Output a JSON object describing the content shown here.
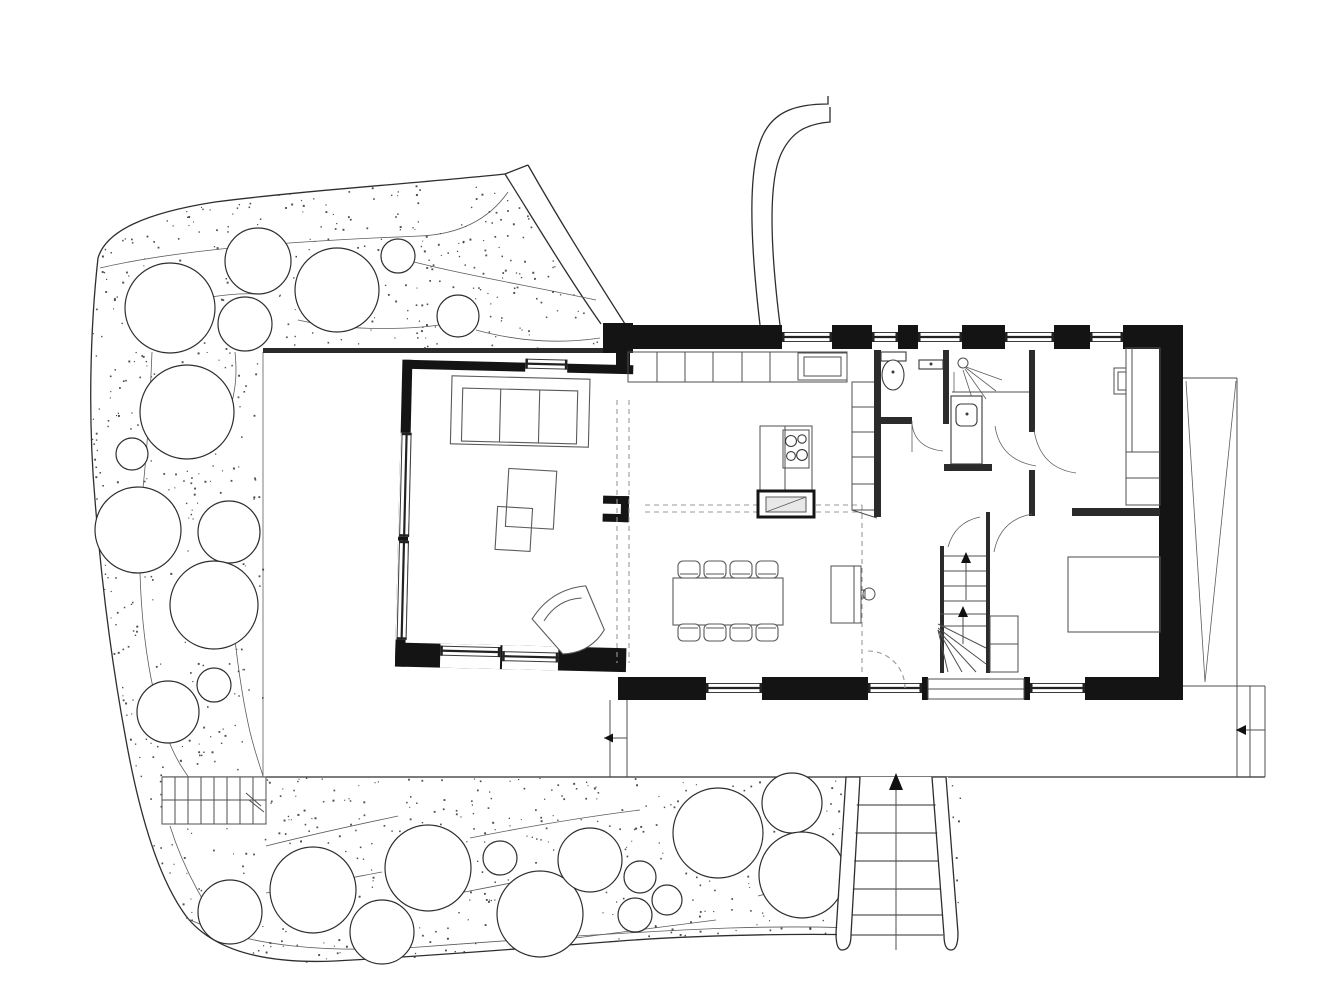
{
  "document": {
    "title": "Site and ground floor plan — black and white architectural line drawing"
  },
  "canvas": {
    "width": 1338,
    "height": 992,
    "background": "#ffffff"
  },
  "palette": {
    "wall": "#141414",
    "outline": "#2e2e2e",
    "thin_line": "#4f4f4f",
    "furniture": "#5a5a5a",
    "dashed": "#999999",
    "stipple": "#2f2f2f",
    "hearth_fill": "#e8e8e8"
  },
  "garden": {
    "stipple": {
      "count": 820,
      "seed": 13,
      "min_size": 1.0,
      "max_size": 2.0
    },
    "band_polygon": [
      [
        505,
        174
      ],
      [
        400,
        184
      ],
      [
        290,
        192
      ],
      [
        215,
        202
      ],
      [
        150,
        213
      ],
      [
        110,
        230
      ],
      [
        98,
        258
      ],
      [
        91,
        330
      ],
      [
        90,
        420
      ],
      [
        95,
        500
      ],
      [
        103,
        590
      ],
      [
        113,
        670
      ],
      [
        126,
        740
      ],
      [
        140,
        812
      ],
      [
        160,
        878
      ],
      [
        186,
        916
      ],
      [
        216,
        950
      ],
      [
        270,
        963
      ],
      [
        335,
        961
      ],
      [
        430,
        956
      ],
      [
        530,
        948
      ],
      [
        620,
        941
      ],
      [
        720,
        934
      ],
      [
        820,
        933
      ],
      [
        905,
        936
      ],
      [
        958,
        934
      ],
      [
        960,
        779
      ],
      [
        263,
        777
      ],
      [
        263,
        352
      ],
      [
        603,
        350
      ],
      [
        570,
        285
      ],
      [
        535,
        205
      ]
    ],
    "trees": [
      {
        "cx": 170,
        "cy": 308,
        "r": 45
      },
      {
        "cx": 258,
        "cy": 261,
        "r": 33
      },
      {
        "cx": 337,
        "cy": 290,
        "r": 42
      },
      {
        "cx": 398,
        "cy": 256,
        "r": 17
      },
      {
        "cx": 245,
        "cy": 324,
        "r": 27
      },
      {
        "cx": 458,
        "cy": 316,
        "r": 21
      },
      {
        "cx": 187,
        "cy": 412,
        "r": 47
      },
      {
        "cx": 132,
        "cy": 454,
        "r": 16
      },
      {
        "cx": 138,
        "cy": 530,
        "r": 43
      },
      {
        "cx": 229,
        "cy": 532,
        "r": 31
      },
      {
        "cx": 214,
        "cy": 605,
        "r": 44
      },
      {
        "cx": 214,
        "cy": 685,
        "r": 17
      },
      {
        "cx": 168,
        "cy": 712,
        "r": 31
      },
      {
        "cx": 230,
        "cy": 912,
        "r": 32
      },
      {
        "cx": 313,
        "cy": 890,
        "r": 43
      },
      {
        "cx": 382,
        "cy": 932,
        "r": 32
      },
      {
        "cx": 428,
        "cy": 868,
        "r": 43
      },
      {
        "cx": 500,
        "cy": 858,
        "r": 17
      },
      {
        "cx": 540,
        "cy": 914,
        "r": 43
      },
      {
        "cx": 590,
        "cy": 860,
        "r": 32
      },
      {
        "cx": 640,
        "cy": 877,
        "r": 16
      },
      {
        "cx": 667,
        "cy": 900,
        "r": 15
      },
      {
        "cx": 635,
        "cy": 915,
        "r": 17
      },
      {
        "cx": 718,
        "cy": 833,
        "r": 45
      },
      {
        "cx": 792,
        "cy": 803,
        "r": 30
      },
      {
        "cx": 802,
        "cy": 875,
        "r": 43
      }
    ]
  },
  "windows": [
    {
      "group": "main",
      "o": "h",
      "a": 782,
      "b": 832,
      "mid": 337,
      "punch": [
        782,
        325,
        50,
        24
      ]
    },
    {
      "group": "main",
      "o": "h",
      "a": 872,
      "b": 898,
      "mid": 337,
      "punch": [
        872,
        325,
        26,
        24
      ]
    },
    {
      "group": "main",
      "o": "h",
      "a": 918,
      "b": 962,
      "mid": 337,
      "punch": [
        918,
        325,
        44,
        24
      ]
    },
    {
      "group": "main",
      "o": "h",
      "a": 1005,
      "b": 1054,
      "mid": 337,
      "punch": [
        1005,
        325,
        49,
        24
      ]
    },
    {
      "group": "main",
      "o": "h",
      "a": 1090,
      "b": 1123,
      "mid": 337,
      "punch": [
        1090,
        325,
        33,
        24
      ]
    },
    {
      "group": "main",
      "o": "h",
      "a": 706,
      "b": 762,
      "mid": 688,
      "punch": [
        706,
        677,
        56,
        23
      ]
    },
    {
      "group": "main",
      "o": "h",
      "a": 868,
      "b": 922,
      "mid": 688,
      "punch": [
        868,
        677,
        54,
        23
      ]
    },
    {
      "group": "main",
      "o": "h",
      "a": 1030,
      "b": 1085,
      "mid": 688,
      "punch": [
        1030,
        677,
        55,
        23
      ]
    },
    {
      "group": "living",
      "o": "h",
      "a": 525,
      "b": 567,
      "mid": 366,
      "punch": [
        525,
        364,
        42,
        11
      ]
    },
    {
      "group": "living",
      "o": "v",
      "a": 438,
      "b": 542,
      "mid": 408,
      "punch": [
        402,
        438,
        10,
        104
      ]
    },
    {
      "group": "living",
      "o": "v",
      "a": 546,
      "b": 645,
      "mid": 408,
      "punch": [
        402,
        546,
        10,
        99
      ]
    },
    {
      "group": "living",
      "o": "h",
      "a": 447,
      "b": 507,
      "mid": 655,
      "punch": [
        447,
        648,
        60,
        24
      ]
    },
    {
      "group": "living",
      "o": "h",
      "a": 509,
      "b": 565,
      "mid": 659,
      "punch": [
        509,
        648,
        56,
        24
      ]
    }
  ],
  "dining": {
    "chairs": [
      {
        "x": 678,
        "y": 561
      },
      {
        "x": 704,
        "y": 561
      },
      {
        "x": 730,
        "y": 561
      },
      {
        "x": 756,
        "y": 561
      },
      {
        "x": 678,
        "y": 624
      },
      {
        "x": 704,
        "y": 624
      },
      {
        "x": 730,
        "y": 624
      },
      {
        "x": 756,
        "y": 624
      }
    ]
  },
  "kitchen": {
    "burners": [
      [
        791,
        441,
        5.5
      ],
      [
        802,
        439,
        4.2
      ],
      [
        791,
        456,
        4.4
      ],
      [
        802,
        455,
        5.4
      ]
    ],
    "counter_dividers": [
      657,
      685,
      713,
      742,
      770
    ],
    "tall_unit_dividers": [
      407,
      432,
      457,
      484
    ]
  },
  "exterior_stair": {
    "tread_ys": [
      805,
      833,
      861,
      889,
      915,
      935
    ]
  },
  "garden_steps": {
    "riser_xs": [
      175,
      188,
      201,
      214,
      227,
      240,
      253
    ]
  },
  "interior_stair": {
    "upper_tread_ys": [
      556,
      571,
      586,
      601
    ],
    "lower_tread_ys": [
      614,
      626
    ]
  }
}
